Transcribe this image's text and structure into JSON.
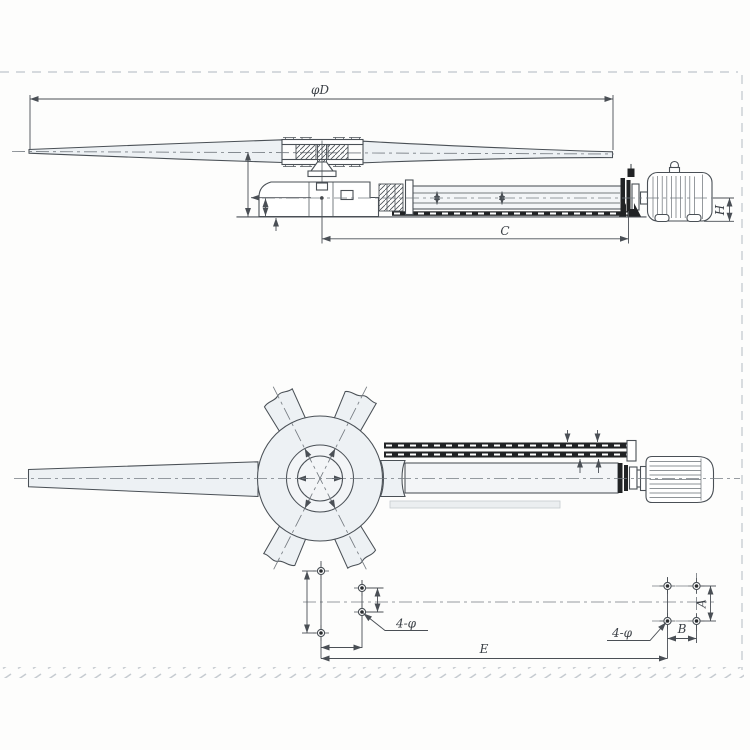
{
  "drawing": {
    "type": "axial-fan-assembly-dimensional-drawing",
    "views": [
      "side-elevation",
      "plan-view",
      "foundation-bolt-layout"
    ],
    "labels": {
      "phi_d": "φD",
      "c": "C",
      "h": "H",
      "e": "E",
      "a": "A",
      "b": "B",
      "front_holes": "4-φ",
      "rear_holes": "4-φ"
    },
    "colors": {
      "line": "#4a5056",
      "dim": "#4a4f55",
      "dark": "#212325",
      "fill_light": "#edf1f4",
      "fill_lighter": "#f3f5f7",
      "border": "#c9ced3",
      "background": "#fdfdfc",
      "text": "#3a3f45"
    }
  }
}
